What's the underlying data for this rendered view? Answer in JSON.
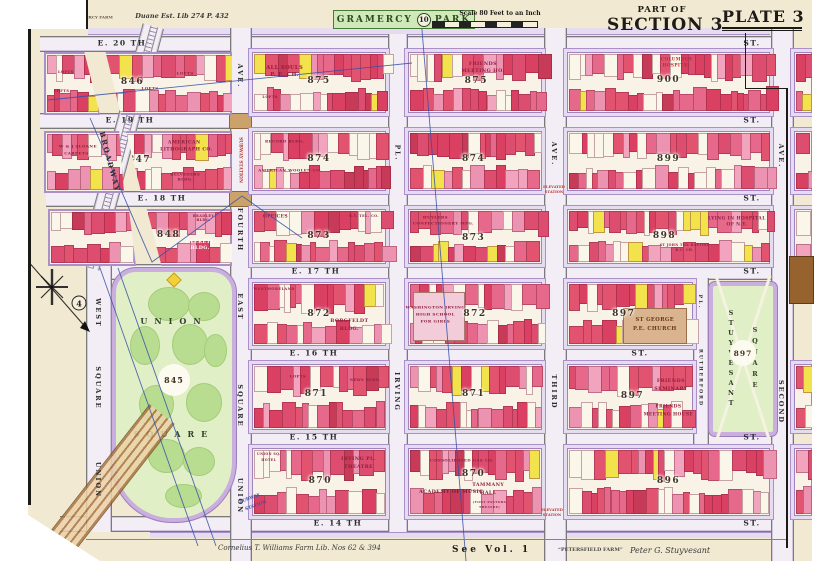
{
  "colors": {
    "paper": "#f1e9d1",
    "street": "#f3edf6",
    "curb": "#ab90c8",
    "sidewalk": "#e6dcf2",
    "park_bg": "#e0efc6",
    "park_blob": "#b9dd90",
    "park_border": "#c9aede",
    "building_deep": [
      "#e2536f",
      "#da4062",
      "#e6688a",
      "#dd4d70"
    ],
    "building_light": [
      "#f2a3bd",
      "#ec93b1"
    ],
    "building_white": "#faf6ea",
    "building_yellow": "#f2e24c",
    "building_dark": "#c73a58",
    "boundary_blue": "#3450a8",
    "station_red": "#b03a30",
    "station_blue": "#3a56a5",
    "church_tan": "#d9b48f",
    "subway_brown": "#a9743e"
  },
  "header": {
    "farm_note": "GRAMERCY FARM",
    "deed_note": "Duane Est. Lib 274 P. 432",
    "park_name_left": "GRAMERCY",
    "park_ref": "10",
    "park_name_right": "PARK",
    "scale_label": "Scale 80 Feet to an Inch",
    "part_of": "PART OF",
    "section": "SECTION 3",
    "plate": "PLATE 3"
  },
  "footer": {
    "farm_left": "Cornelius T. Williams Farm Lib. Nos 62 & 394",
    "see_vol": "See Vol. 1",
    "petersfield": "“PETERSFIELD FARM”",
    "stuyvesant_note": "Peter G. Stuyvesant"
  },
  "plate_refs": [
    {
      "n": "4",
      "x": 79,
      "y": 303
    },
    {
      "n": "2",
      "x": 797,
      "y": 293
    }
  ],
  "streets_h": [
    {
      "id": "e-20th",
      "name": "E. 20 TH",
      "suffix": "ST.",
      "y": 36,
      "x1": 40,
      "x2": 786,
      "name_x": 122,
      "suffix_x": 752
    },
    {
      "id": "e-19th",
      "name": "E. 19 TH",
      "suffix": "ST.",
      "y": 113,
      "x1": 40,
      "x2": 786,
      "name_x": 130,
      "suffix_x": 752
    },
    {
      "id": "e-18th",
      "name": "E. 18 TH",
      "suffix": "ST.",
      "y": 191,
      "x1": 46,
      "x2": 786,
      "name_x": 162,
      "suffix_x": 752
    },
    {
      "id": "e-17th",
      "name": "E. 17 TH",
      "suffix": "ST.",
      "y": 264,
      "x1": 86,
      "x2": 786,
      "name_x": 316,
      "suffix_x": 752
    },
    {
      "id": "e-16th",
      "name": "E. 16 TH",
      "suffix": "ST.",
      "y": 346,
      "x1": 230,
      "x2": 695,
      "name_x": 314,
      "suffix_x": 640
    },
    {
      "id": "e-15th",
      "name": "E. 15 TH",
      "suffix": "ST.",
      "y": 430,
      "x1": 230,
      "x2": 786,
      "name_x": 314,
      "suffix_x": 752
    },
    {
      "id": "e-14th",
      "name": "E. 14 TH",
      "suffix": "ST.",
      "y": 516,
      "x1": 60,
      "x2": 786,
      "name_x": 338,
      "suffix_x": 752
    }
  ],
  "streets_v": [
    {
      "id": "fourth-ave",
      "x": 230,
      "w": 20,
      "y1": 28,
      "y2": 561
    },
    {
      "id": "irving-pl",
      "x": 388,
      "w": 18,
      "y1": 34,
      "y2": 532
    },
    {
      "id": "third-ave",
      "x": 544,
      "w": 21,
      "y1": 28,
      "y2": 561
    },
    {
      "id": "rutherford-pl",
      "x": 693,
      "w": 14,
      "y1": 278,
      "y2": 448
    },
    {
      "id": "second-ave",
      "x": 771,
      "w": 21,
      "y1": 28,
      "y2": 561
    },
    {
      "id": "union-sq-west",
      "x": 86,
      "w": 24,
      "y1": 264,
      "y2": 532
    }
  ],
  "avenue_labels": [
    {
      "t": "BROADWAY",
      "x": 110,
      "y": 162,
      "rot": 75,
      "s": 7
    },
    {
      "t": "AVE.",
      "x": 240,
      "y": 76,
      "s": 6.5
    },
    {
      "t": "FOURTH",
      "x": 240,
      "y": 230,
      "s": 6.5
    },
    {
      "t": "EAST",
      "x": 240,
      "y": 307,
      "s": 6.5
    },
    {
      "t": "SQUARE",
      "x": 240,
      "y": 406,
      "s": 6.5
    },
    {
      "t": "UNION",
      "x": 240,
      "y": 496,
      "s": 6.5
    },
    {
      "t": "WEST",
      "x": 98,
      "y": 313,
      "s": 6.5
    },
    {
      "t": "SQUARE",
      "x": 98,
      "y": 388,
      "s": 6.5
    },
    {
      "t": "UNION",
      "x": 98,
      "y": 480,
      "s": 6.5
    },
    {
      "t": "PL.",
      "x": 397,
      "y": 153,
      "s": 6
    },
    {
      "t": "IRVING",
      "x": 397,
      "y": 392,
      "s": 6.5
    },
    {
      "t": "AVE.",
      "x": 554,
      "y": 154,
      "s": 6.5
    },
    {
      "t": "THIRD",
      "x": 554,
      "y": 392,
      "s": 6.5
    },
    {
      "t": "PL.",
      "x": 700,
      "y": 302,
      "s": 5
    },
    {
      "t": "RUTHERFORD",
      "x": 700,
      "y": 378,
      "s": 4.6
    },
    {
      "t": "AVE.",
      "x": 781,
      "y": 156,
      "s": 6.5
    },
    {
      "t": "SECOND",
      "x": 781,
      "y": 402,
      "s": 6.5
    }
  ],
  "annotations": [
    {
      "t": "SUBWAY STATION",
      "x": 240,
      "y": 160,
      "rot": 90,
      "s": 4.4,
      "c": "#b03a30"
    },
    {
      "t": "SUBWAY",
      "x": 250,
      "y": 499,
      "s": 4.4,
      "c": "#3a56a5",
      "rot": -20
    },
    {
      "t": "STATION",
      "x": 256,
      "y": 506,
      "s": 4.4,
      "c": "#3a56a5",
      "rot": -20
    },
    {
      "t": "ELEVATED",
      "x": 554,
      "y": 187,
      "s": 3.6,
      "c": "#b03a30"
    },
    {
      "t": "STATION",
      "x": 554,
      "y": 192,
      "s": 3.6,
      "c": "#b03a30"
    },
    {
      "t": "ELEVATED",
      "x": 552,
      "y": 510,
      "s": 3.6,
      "c": "#b03a30"
    },
    {
      "t": "STATION",
      "x": 552,
      "y": 515,
      "s": 3.6,
      "c": "#b03a30"
    },
    {
      "t": "GRAMERCY FARM",
      "x": 92,
      "y": 17,
      "s": 4,
      "c": "#6a5a4a"
    },
    {
      "t": "Duane Est. Lib 274 P. 432",
      "x": 182,
      "y": 16,
      "s": 6.5,
      "c": "#3a3a3a",
      "i": 1
    }
  ],
  "parks": {
    "union": {
      "line1": "UNION",
      "line2": "SQUARE",
      "number": "845",
      "x": 112,
      "y": 268,
      "w": 116,
      "h": 246
    },
    "stuyvesant": {
      "word1": "STUYVESANT",
      "word2": "SQUARE",
      "number": "897",
      "x": 709,
      "y": 282,
      "w": 60,
      "h": 146
    }
  },
  "blocks": [
    {
      "num": "",
      "x": 44,
      "y": 52,
      "w": 52,
      "h": 59,
      "clip": "polygon(0% 0%,72% 0%,100% 100%,0% 100%)",
      "labels": [
        {
          "t": "LOFTS",
          "x": 38,
          "y": 30,
          "s": 3.6
        },
        {
          "t": "LOFTS",
          "x": 30,
          "y": 62,
          "s": 3.6
        }
      ]
    },
    {
      "num": "",
      "x": 44,
      "y": 131,
      "w": 76,
      "h": 58,
      "clip": "polygon(0% 0%,94% 0%,100% 100%,0% 100%)",
      "labels": [
        {
          "t": "W & J SLOANE",
          "x": 42,
          "y": 22,
          "s": 4
        },
        {
          "t": "CARPETS",
          "x": 40,
          "y": 34,
          "s": 4
        }
      ]
    },
    {
      "num": "",
      "x": 48,
      "y": 209,
      "w": 84,
      "h": 53,
      "clip": "polygon(0% 0%,92% 0%,100% 100%,0% 100%)",
      "labels": []
    },
    {
      "num": "846",
      "x": 103,
      "y": 52,
      "w": 125,
      "h": 59,
      "nx": 22,
      "ny": 47,
      "clip": "polygon(2% 0%,100% 0%,100% 100%,14% 100%)",
      "labels": [
        {
          "t": "LOFTS",
          "x": 36,
          "y": 58,
          "s": 4
        },
        {
          "t": "LOFTS",
          "x": 64,
          "y": 32,
          "s": 4
        }
      ]
    },
    {
      "num": "875",
      "x": 252,
      "y": 52,
      "w": 132,
      "h": 59,
      "nx": 50,
      "ny": 47,
      "labels": [
        {
          "t": "ALL SOULS",
          "x": 24,
          "y": 25,
          "s": 5.2,
          "c": "#9c1c35"
        },
        {
          "t": "P. E. CH.",
          "x": 24,
          "y": 38,
          "s": 5.2,
          "c": "#9c1c35"
        },
        {
          "t": "LOFTS",
          "x": 13,
          "y": 75,
          "s": 3.6
        }
      ]
    },
    {
      "num": "875",
      "x": 408,
      "y": 52,
      "w": 132,
      "h": 59,
      "nx": 51,
      "ny": 47,
      "labels": [
        {
          "t": "FRIENDS",
          "x": 56,
          "y": 18,
          "s": 4.8
        },
        {
          "t": "MEETING HO.",
          "x": 56,
          "y": 30,
          "s": 4.8
        }
      ]
    },
    {
      "num": "900",
      "x": 567,
      "y": 52,
      "w": 201,
      "h": 59,
      "nx": 50,
      "ny": 46,
      "labels": [
        {
          "t": "COLUMBUS",
          "x": 54,
          "y": 10,
          "s": 4.2,
          "c": "#b03030"
        },
        {
          "t": "HOSPITAL",
          "x": 54,
          "y": 20,
          "s": 4.2,
          "c": "#b03030"
        }
      ]
    },
    {
      "num": "847",
      "x": 124,
      "y": 131,
      "w": 104,
      "h": 58,
      "nx": 13,
      "ny": 47,
      "clip": "polygon(2% 0%,100% 0%,100% 100%,16% 100%)",
      "labels": [
        {
          "t": "AMERICAN",
          "x": 56,
          "y": 18,
          "s": 4.6
        },
        {
          "t": "LITHOGRAPH CO.",
          "x": 58,
          "y": 30,
          "s": 4.6
        },
        {
          "t": "BELVEDERE",
          "x": 57,
          "y": 70,
          "s": 3.8
        },
        {
          "t": "BLDG.",
          "x": 57,
          "y": 80,
          "s": 3.8
        }
      ]
    },
    {
      "num": "874",
      "x": 252,
      "y": 131,
      "w": 132,
      "h": 58,
      "nx": 50,
      "ny": 47,
      "labels": [
        {
          "t": "RECORD BLDG.",
          "x": 24,
          "y": 15,
          "s": 3.9
        },
        {
          "t": "AMERICAN WOOLEN CO.",
          "x": 28,
          "y": 66,
          "s": 3.9
        }
      ]
    },
    {
      "num": "874",
      "x": 408,
      "y": 131,
      "w": 132,
      "h": 58,
      "nx": 49,
      "ny": 47,
      "labels": []
    },
    {
      "num": "899",
      "x": 567,
      "y": 131,
      "w": 201,
      "h": 58,
      "nx": 50,
      "ny": 47,
      "labels": []
    },
    {
      "num": "848",
      "x": 145,
      "y": 209,
      "w": 83,
      "h": 53,
      "nx": 26,
      "ny": 45,
      "clip": "polygon(2% 0%,100% 0%,100% 100%,19% 100%)",
      "labels": [
        {
          "t": "BRADLEY",
          "x": 68,
          "y": 9,
          "s": 3.4
        },
        {
          "t": "BLDG.",
          "x": 68,
          "y": 17,
          "s": 3.4
        },
        {
          "t": "EVERETT",
          "x": 64,
          "y": 58,
          "s": 4.8,
          "c": "#ffffff"
        },
        {
          "t": "BLDG.",
          "x": 64,
          "y": 70,
          "s": 4.8,
          "c": "#ffffff"
        }
      ]
    },
    {
      "num": "873",
      "x": 252,
      "y": 209,
      "w": 132,
      "h": 53,
      "nx": 50,
      "ny": 49,
      "labels": [
        {
          "t": "OFFICES",
          "x": 17,
          "y": 14,
          "s": 4.4
        },
        {
          "t": "N.Y. TEL. CO.",
          "x": 84,
          "y": 11,
          "s": 3.4
        }
      ]
    },
    {
      "num": "873",
      "x": 408,
      "y": 209,
      "w": 132,
      "h": 53,
      "nx": 49,
      "ny": 53,
      "labels": [
        {
          "t": "HUYLERS",
          "x": 20,
          "y": 14,
          "s": 4
        },
        {
          "t": "CONFECTIONERY MFG.",
          "x": 26,
          "y": 24,
          "s": 4
        }
      ]
    },
    {
      "num": "898",
      "x": 567,
      "y": 209,
      "w": 201,
      "h": 53,
      "nx": 48,
      "ny": 49,
      "labels": [
        {
          "t": "LYING IN HOSPITAL",
          "x": 84,
          "y": 17,
          "s": 4.4
        },
        {
          "t": "OF N.Y.",
          "x": 84,
          "y": 29,
          "s": 4.4
        },
        {
          "t": "ST JOHN THE BAPTIST",
          "x": 58,
          "y": 66,
          "s": 3.2
        },
        {
          "t": "R.C. CH.",
          "x": 58,
          "y": 75,
          "s": 3.2
        }
      ]
    },
    {
      "num": "872",
      "x": 252,
      "y": 282,
      "w": 132,
      "h": 62,
      "nx": 50,
      "ny": 50,
      "labels": [
        {
          "t": "WESTMORELAND",
          "x": 16,
          "y": 9,
          "s": 3.6
        },
        {
          "t": "BORGFELDT",
          "x": 73,
          "y": 62,
          "s": 4.8
        },
        {
          "t": "BLDG.",
          "x": 73,
          "y": 74,
          "s": 4.8
        }
      ]
    },
    {
      "num": "872",
      "x": 408,
      "y": 282,
      "w": 132,
      "h": 62,
      "nx": 50,
      "ny": 50,
      "extra": [
        {
          "x": 3,
          "y": 14,
          "w": 38,
          "h": 76,
          "c": "#f2ccd9"
        }
      ],
      "labels": [
        {
          "t": "WASHINGTON IRVING",
          "x": 20,
          "y": 38,
          "s": 4.1
        },
        {
          "t": "HIGH SCHOOL",
          "x": 20,
          "y": 50,
          "s": 4.1
        },
        {
          "t": "FOR GIRLS",
          "x": 20,
          "y": 62,
          "s": 4.1
        }
      ]
    },
    {
      "num": "897",
      "x": 567,
      "y": 282,
      "w": 124,
      "h": 62,
      "nx": 45,
      "ny": 50,
      "extra": [
        {
          "x": 44,
          "y": 40,
          "w": 50,
          "h": 55,
          "c": "#d9b48f"
        }
      ],
      "labels": [
        {
          "t": "ST GEORGE",
          "x": 70,
          "y": 60,
          "s": 5.2,
          "c": "#6b3a14"
        },
        {
          "t": "P.E. CHURCH",
          "x": 70,
          "y": 74,
          "s": 5.2,
          "c": "#6b3a14"
        }
      ]
    },
    {
      "num": "871",
      "x": 252,
      "y": 364,
      "w": 132,
      "h": 64,
      "nx": 48,
      "ny": 45,
      "labels": [
        {
          "t": "LOFTS",
          "x": 34,
          "y": 17,
          "s": 3.8
        },
        {
          "t": "NEWS BLDG.",
          "x": 85,
          "y": 23,
          "s": 3.6
        }
      ]
    },
    {
      "num": "871",
      "x": 408,
      "y": 364,
      "w": 132,
      "h": 64,
      "nx": 49,
      "ny": 45,
      "labels": []
    },
    {
      "num": "897",
      "x": 567,
      "y": 364,
      "w": 124,
      "h": 64,
      "nx": 52,
      "ny": 48,
      "labels": [
        {
          "t": "FRIENDS",
          "x": 83,
          "y": 25,
          "s": 4.8
        },
        {
          "t": "SEMINARY",
          "x": 83,
          "y": 37,
          "s": 4.8
        },
        {
          "t": "FRIENDS",
          "x": 81,
          "y": 66,
          "s": 4.4
        },
        {
          "t": "MEETING HOUSE",
          "x": 81,
          "y": 78,
          "s": 4.4
        }
      ]
    },
    {
      "num": "870",
      "x": 252,
      "y": 448,
      "w": 132,
      "h": 66,
      "nx": 51,
      "ny": 48,
      "labels": [
        {
          "t": "UNION SQ.",
          "x": 12,
          "y": 8,
          "s": 3.2
        },
        {
          "t": "HOTEL",
          "x": 12,
          "y": 16,
          "s": 3.2
        },
        {
          "t": "IRVING PL.",
          "x": 80,
          "y": 15,
          "s": 4.8
        },
        {
          "t": "THEATRE",
          "x": 80,
          "y": 27,
          "s": 4.8
        }
      ]
    },
    {
      "num": "870",
      "x": 408,
      "y": 448,
      "w": 132,
      "h": 66,
      "nx": 49,
      "ny": 38,
      "labels": [
        {
          "t": "CONSOLIDATED GAS CO.",
          "x": 40,
          "y": 16,
          "s": 3.9
        },
        {
          "t": "ACADEMY OF MUSIC",
          "x": 32,
          "y": 65,
          "s": 4.8,
          "c": "#7c1a35"
        },
        {
          "t": "TAMMANY",
          "x": 60,
          "y": 55,
          "s": 4.8
        },
        {
          "t": "HALL",
          "x": 60,
          "y": 67,
          "s": 4.8
        },
        {
          "t": "(TONY PASTORS",
          "x": 61,
          "y": 80,
          "s": 3
        },
        {
          "t": "THEATRE)",
          "x": 61,
          "y": 88,
          "s": 3
        }
      ]
    },
    {
      "num": "896",
      "x": 567,
      "y": 448,
      "w": 201,
      "h": 66,
      "nx": 50,
      "ny": 48,
      "labels": []
    },
    {
      "num": "",
      "x": 794,
      "y": 52,
      "w": 16,
      "h": 59,
      "labels": []
    },
    {
      "num": "",
      "x": 794,
      "y": 131,
      "w": 16,
      "h": 58,
      "labels": []
    },
    {
      "num": "",
      "x": 794,
      "y": 209,
      "w": 16,
      "h": 53,
      "labels": []
    },
    {
      "num": "",
      "x": 794,
      "y": 364,
      "w": 16,
      "h": 64,
      "labels": []
    },
    {
      "num": "",
      "x": 794,
      "y": 448,
      "w": 16,
      "h": 66,
      "labels": []
    }
  ]
}
